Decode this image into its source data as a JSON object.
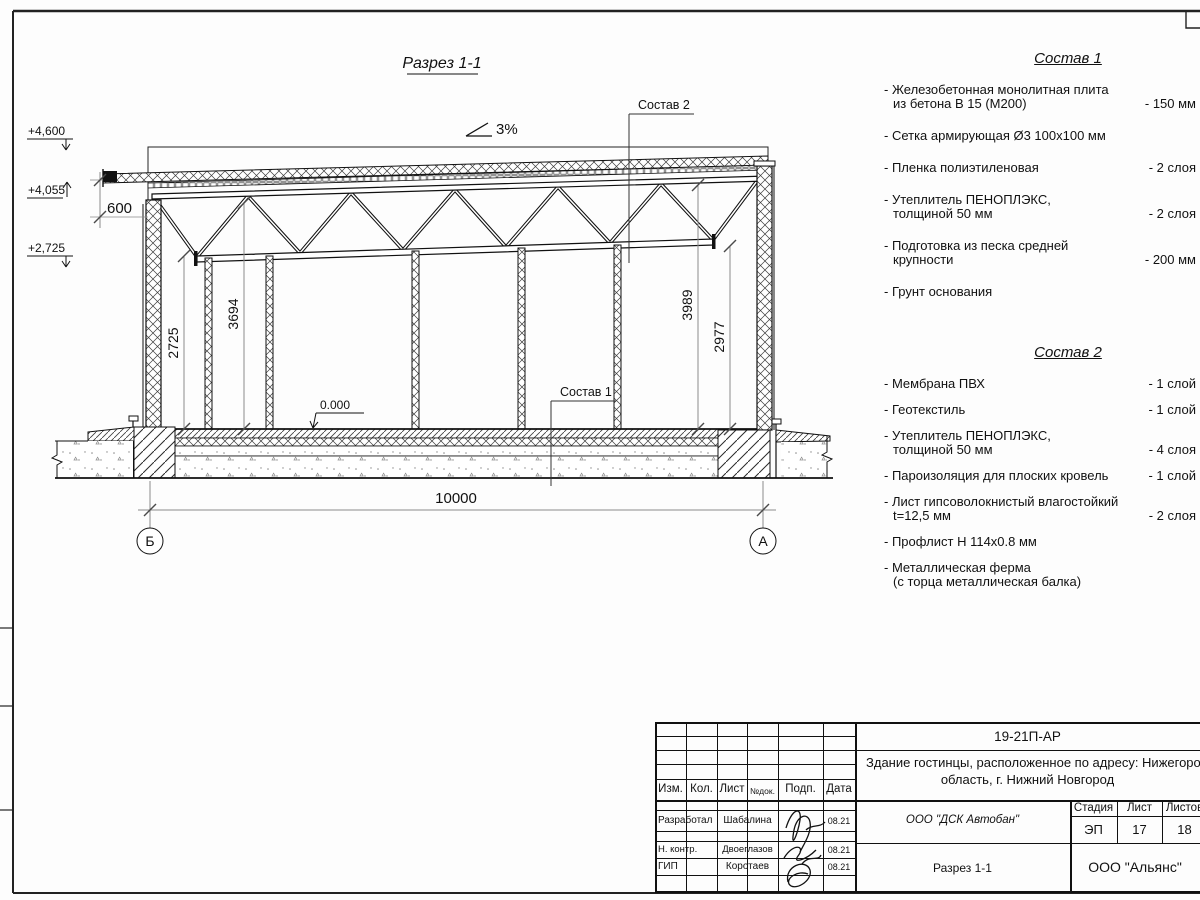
{
  "sheet": {
    "title": "Разрез 1-1",
    "slope": "3%",
    "levels": {
      "parapet": "+4,600",
      "roof": "+4,055",
      "truss": "+2,725",
      "zero": "0.000"
    },
    "dims": {
      "eave": "600",
      "left_truss": "2725",
      "left_roof": "3694",
      "right_roof": "3989",
      "right_truss": "2977",
      "span": "10000"
    },
    "axis_left": "Б",
    "axis_right": "А",
    "callout1": "Состав 1",
    "callout2": "Состав 2"
  },
  "sostav1": {
    "title": "Состав 1",
    "items": [
      {
        "line1": "- Железобетонная  монолитная плита",
        "line2": "из бетона В 15 (М200)",
        "qty": "- 150 мм"
      },
      {
        "line1": "- Сетка армирующая Ø3 100х100 мм",
        "line2": "",
        "qty": ""
      },
      {
        "line1": "- Пленка полиэтиленовая",
        "line2": "",
        "qty": "-  2 слоя"
      },
      {
        "line1": "- Утеплитель ПЕНОПЛЭКС,",
        "line2": "толщиной 50 мм",
        "qty": "- 2 слоя"
      },
      {
        "line1": "- Подготовка из песка средней",
        "line2": "крупности",
        "qty": "- 200 мм"
      },
      {
        "line1": "- Грунт основания",
        "line2": "",
        "qty": ""
      }
    ]
  },
  "sostav2": {
    "title": "Состав 2",
    "items": [
      {
        "line1": "- Мембрана ПВХ",
        "line2": "",
        "qty": "- 1 слой"
      },
      {
        "line1": "- Геотекстиль",
        "line2": "",
        "qty": "- 1 слой"
      },
      {
        "line1": "- Утеплитель ПЕНОПЛЭКС,",
        "line2": "толщиной 50 мм",
        "qty": "- 4 слоя"
      },
      {
        "line1": "- Пароизоляция для плоских кровель",
        "line2": "",
        "qty": "- 1 слой"
      },
      {
        "line1": "- Лист гипсоволокнистый влагостойкий",
        "line2": "t=12,5 мм",
        "qty": "- 2 слоя"
      },
      {
        "line1": "- Профлист Н 114х0.8 мм",
        "line2": "",
        "qty": ""
      },
      {
        "line1": "- Металлическая ферма",
        "line2": "(с торца металлическая балка)",
        "qty": ""
      }
    ]
  },
  "titleblock": {
    "doc_number": "19-21П-АР",
    "project_line1": "Здание гостинцы, расположенное по адресу: Нижегородская",
    "project_line2": "область, г. Нижний Новгород",
    "contractor": "ООО \"ДСК Автобан\"",
    "drawing_name": "Разрез 1-1",
    "company": "ООО \"Альянс\"",
    "stage_label": "Стадия",
    "sheet_label": "Лист",
    "sheets_label": "Листов",
    "stage": "ЭП",
    "sheet_no": "17",
    "sheets_total": "18",
    "col_headers": [
      "Изм.",
      "Кол.",
      "Лист",
      "№док.",
      "Подп.",
      "Дата"
    ],
    "rows": [
      {
        "role": "Разработал",
        "name": "Шабалина",
        "date": "08.21"
      },
      {
        "role": "Н. контр.",
        "name": "Двоеглазов",
        "date": "08.21"
      },
      {
        "role": "ГИП",
        "name": "Коротаев",
        "date": "08.21"
      }
    ]
  }
}
